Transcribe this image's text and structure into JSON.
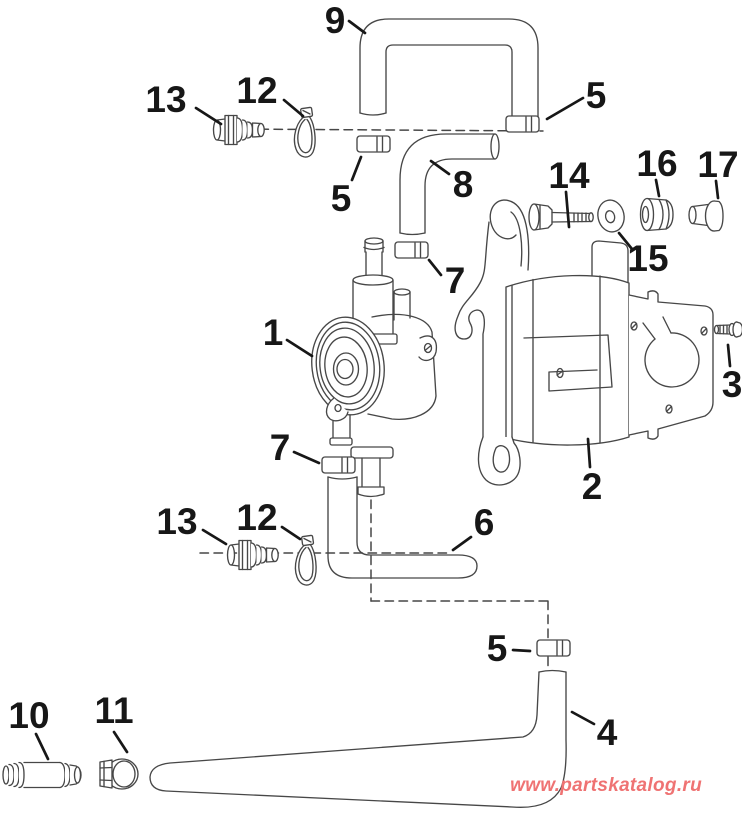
{
  "diagram": {
    "type": "exploded-parts-diagram",
    "background": "#ffffff",
    "line_color": "#474747",
    "label_color": "#171717",
    "watermark": {
      "text": "www.partskatalog.ru",
      "color": "#ef7373"
    },
    "callouts": [
      {
        "label": "9"
      },
      {
        "label": "13"
      },
      {
        "label": "12"
      },
      {
        "label": "5"
      },
      {
        "label": "5"
      },
      {
        "label": "8"
      },
      {
        "label": "14"
      },
      {
        "label": "16"
      },
      {
        "label": "17"
      },
      {
        "label": "15"
      },
      {
        "label": "1"
      },
      {
        "label": "7"
      },
      {
        "label": "3"
      },
      {
        "label": "2"
      },
      {
        "label": "7"
      },
      {
        "label": "13"
      },
      {
        "label": "12"
      },
      {
        "label": "6"
      },
      {
        "label": "5"
      },
      {
        "label": "4"
      },
      {
        "label": "10"
      },
      {
        "label": "11"
      }
    ]
  }
}
